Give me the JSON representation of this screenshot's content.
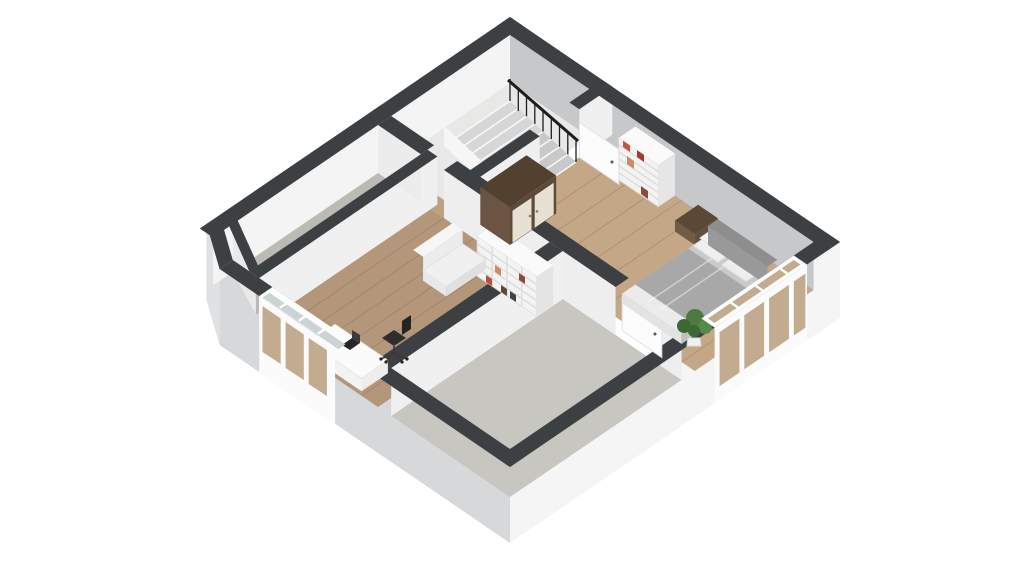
{
  "meta": {
    "type": "3d-floor-plan",
    "style": "dollhouse-axonometric",
    "background": "white",
    "text_visible": "none"
  },
  "rooms": [
    {
      "name": "attic-storage",
      "floor": "concrete",
      "position": "top-left-strip",
      "furniture": []
    },
    {
      "name": "stair-landing",
      "floor": "light-screed",
      "position": "top-center",
      "furniture": [
        "staircase",
        "black-railing"
      ]
    },
    {
      "name": "study",
      "floor": "wood",
      "position": "center-left",
      "furniture": [
        "desk",
        "laptop",
        "office-chair",
        "armchair",
        "cube-bookshelf"
      ]
    },
    {
      "name": "bedroom",
      "floor": "wood",
      "position": "right",
      "furniture": [
        "double-bed",
        "pillows",
        "headboard",
        "nightstand",
        "bookshelf-with-books",
        "wardrobe",
        "potted-plant"
      ]
    },
    {
      "name": "unfinished-room",
      "floor": "concrete",
      "position": "bottom",
      "furniture": []
    }
  ],
  "features": [
    "charcoal-wall-tops",
    "white-exterior-shell",
    "open-interior-doors",
    "study-window-band",
    "bedroom-window-band",
    "chamfered-left-corner"
  ],
  "palette": {
    "wall_top": "#3c4043",
    "face_white": "#f4f4f4",
    "face_light": "#f0f0f1",
    "face_mid": "#ececec",
    "face_shadow": "#c6c8ca",
    "ext_gray": "#d7d8da",
    "ext_light": "#f5f5f6",
    "ext_mid": "#e0e1e3",
    "floor_concrete": "#bcbab5",
    "floor_concrete2": "#c8c6c1",
    "floor_landing": "#e8e8e7",
    "wood": "#b4977a",
    "wood_light": "#c3a786",
    "wood_hall": "#bda183",
    "plank": "#7a5c3c",
    "walnut_top": "#52412f",
    "walnut_side": "#6b5443",
    "walnut_front": "#5d4a39",
    "cream": "#e8e1d3",
    "white_f": "#f3f3f3",
    "shelf_line": "#dcdcdc",
    "book1": "#b8503c",
    "book2": "#47403b",
    "book3": "#d08a63",
    "book4": "#8a4a3c",
    "book5": "#c2563e",
    "book6": "#a33b2e",
    "duvet": "#a8a8a8",
    "bed_top": "#c9c9c9",
    "bed_fold": "#ebebeb",
    "pillow": "#efefef",
    "headboard": "#999999",
    "bed_side": "#bfbfbf",
    "bed_foot": "#e3e3e3",
    "night_top": "#5b4836",
    "night_front": "#705b49",
    "night_side": "#634f3e",
    "glass": "#ccd3d5",
    "glass_wood": "#c2ab8e",
    "frame": "#fdfdfd",
    "railing": "#1d1d1f",
    "laptop": "#262626",
    "chair": "#2e2e2e",
    "plant1": "#4c7a41",
    "plant2": "#3e6736",
    "plant3": "#558a49",
    "pot": "#f0f0f0",
    "stair_pit": "#d6d6d6",
    "tread": "#f8f8f8"
  }
}
